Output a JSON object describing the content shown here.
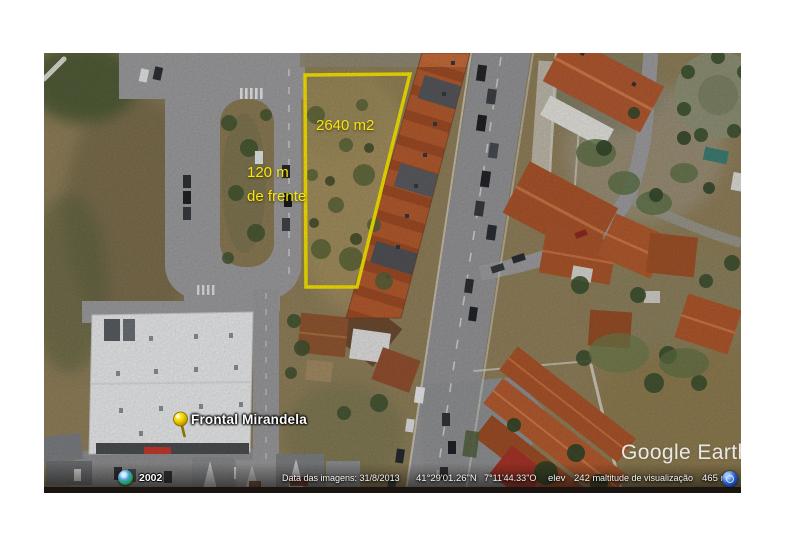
{
  "annotations": {
    "area_label": "2640 m2",
    "frontage_line1": "120 m",
    "frontage_line2": "de frente",
    "annotation_color": "#f5e400",
    "polygon_color": "#f5e400"
  },
  "placemark": {
    "label": "Frontal Mirandela",
    "icon": "yellow-pushpin-icon"
  },
  "watermark": {
    "text": "Google Earth"
  },
  "history_chip": {
    "icon": "historical-imagery-globe-icon",
    "year": "2002"
  },
  "status_bar": {
    "imagery_date": "Data das imagens: 31/8/2013",
    "latitude": "41°29'01.26\"N",
    "longitude": "7°11'44.33\"O",
    "elev_label": "elev",
    "elev_value": "242 m",
    "view_altitude_label": "altitude de visualização",
    "view_altitude_value": "465 m",
    "eye_icon": "eye-altitude-icon"
  }
}
